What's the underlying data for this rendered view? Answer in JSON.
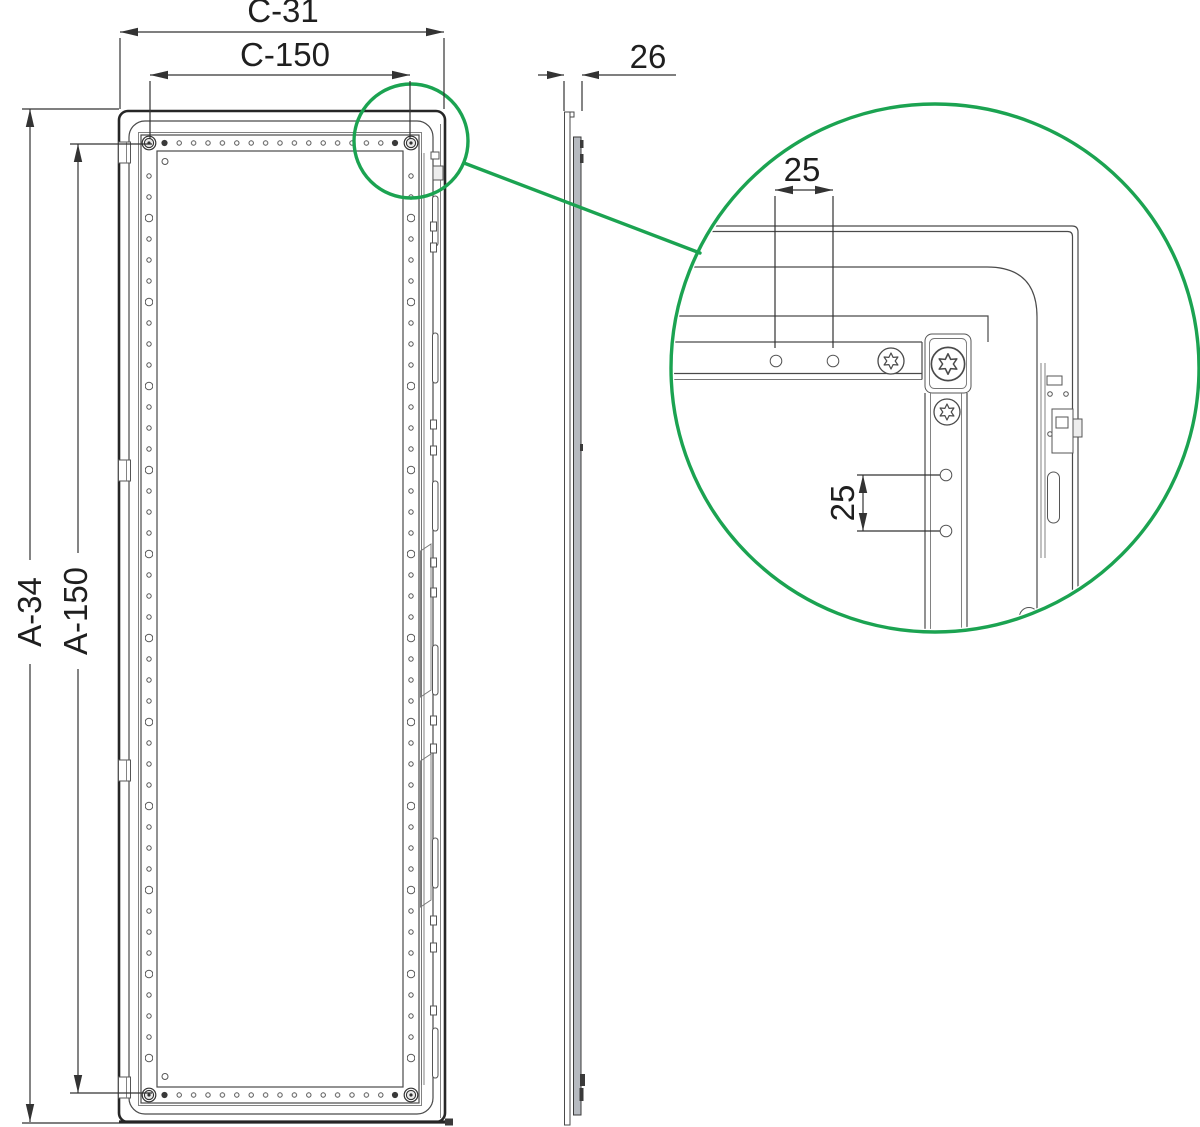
{
  "front_view": {
    "width_outer_label": "C-31",
    "width_inner_label": "C-150",
    "height_outer_label": "A-34",
    "height_inner_label": "A-150"
  },
  "side_view": {
    "thickness_label": "26"
  },
  "detail_view": {
    "horizontal_pitch_label": "25",
    "vertical_pitch_label": "25"
  },
  "colors": {
    "highlight_green": "#1BA351",
    "line_dark": "#2B2B2B",
    "line_medium": "#4A4A4A",
    "profile_gray": "#B6BAC0"
  }
}
